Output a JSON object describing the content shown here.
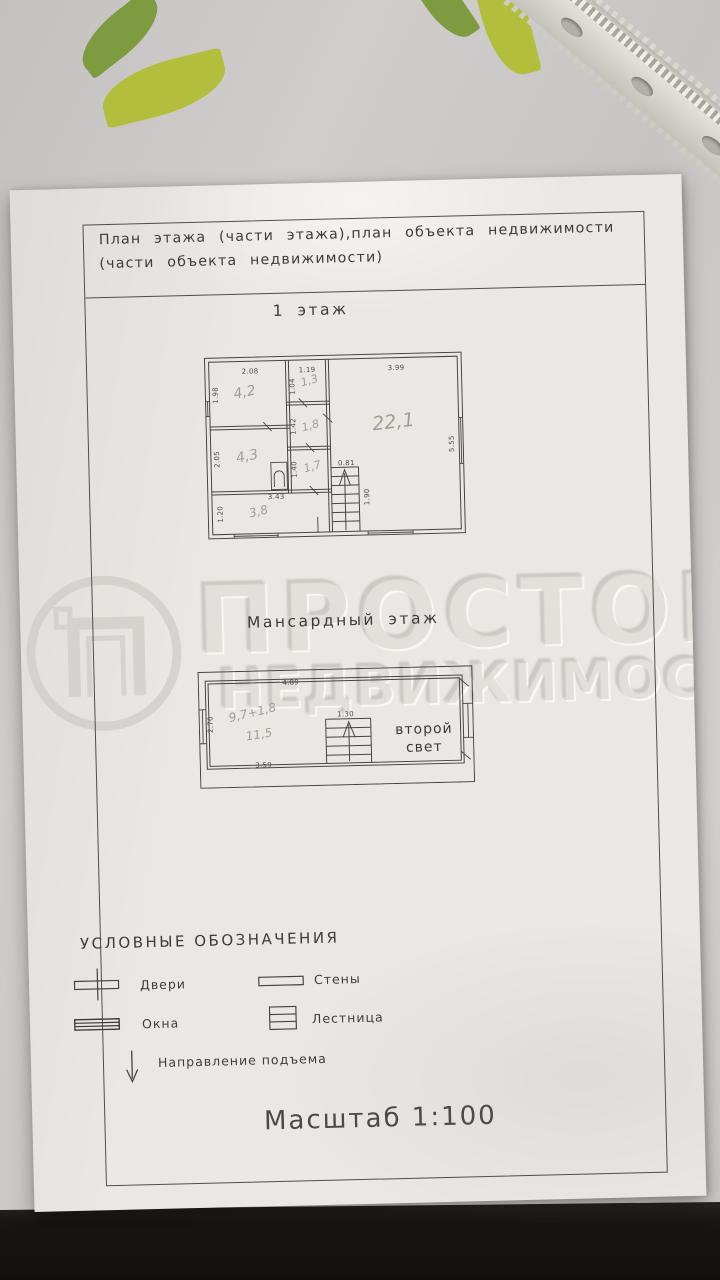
{
  "photo": {
    "colors": {
      "paper": "#eae8e4",
      "ink": "#454545",
      "pencil": "#a29e94",
      "tablecloth": "#cbc9c7",
      "leaf_dark": "#7e9b3f",
      "leaf_light": "#b2bf3d",
      "floor_dark": "#171513",
      "watermark": "#d0cec9"
    }
  },
  "document": {
    "header": {
      "line1": "План этажа (части этажа),план объекта недвижимости",
      "line2": "(части объекта недвижимости)"
    },
    "floor1": {
      "title": "1 этаж",
      "dims": {
        "room1_w": "2.08",
        "room1_h": "1.98",
        "room2_w": "1.19",
        "room2_h": "1.04",
        "room3_w": "3.99",
        "room3_h": "5.55",
        "hall_h": "1.42",
        "room4_h": "2.05",
        "room5_h": "1.40",
        "room6_w": "3.43",
        "room6_h": "1.20",
        "stairs_w": "0.81",
        "stairs_h": "1.90"
      },
      "areas": {
        "room1": "4,2",
        "room2": "1,3",
        "room3": "22,1",
        "hall": "1,8",
        "room4": "4,3",
        "room5": "1,7",
        "room6": "3,8"
      }
    },
    "attic": {
      "title": "Мансардный этаж",
      "dims": {
        "width": "4.89",
        "left": "2.70",
        "stairs": "1.30",
        "bottom": "3.59"
      },
      "notes": {
        "calc": "9,7+1,8",
        "total": "11,5"
      },
      "void_label_line1": "второй",
      "void_label_line2": "свет"
    },
    "legend": {
      "title": "УСЛОВНЫЕ ОБОЗНАЧЕНИЯ",
      "items": [
        {
          "label": "Двери"
        },
        {
          "label": "Стены"
        },
        {
          "label": "Окна"
        },
        {
          "label": "Лестница"
        },
        {
          "label": "Направление подъема"
        }
      ]
    },
    "scale_note": "Масштаб 1:100",
    "watermark": {
      "brand": "ПРОСТОР",
      "brand_line2": "НЕДВИЖИМОСТЬ"
    }
  }
}
